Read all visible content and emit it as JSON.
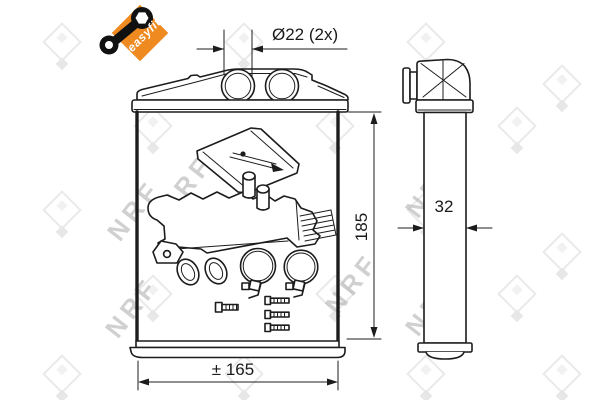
{
  "badge": {
    "label": "easyfit"
  },
  "watermark": {
    "brand": "NRF"
  },
  "dimensions": {
    "ports": "Ø22 (2x)",
    "height": "185",
    "width": "± 165",
    "depth": "32"
  }
}
